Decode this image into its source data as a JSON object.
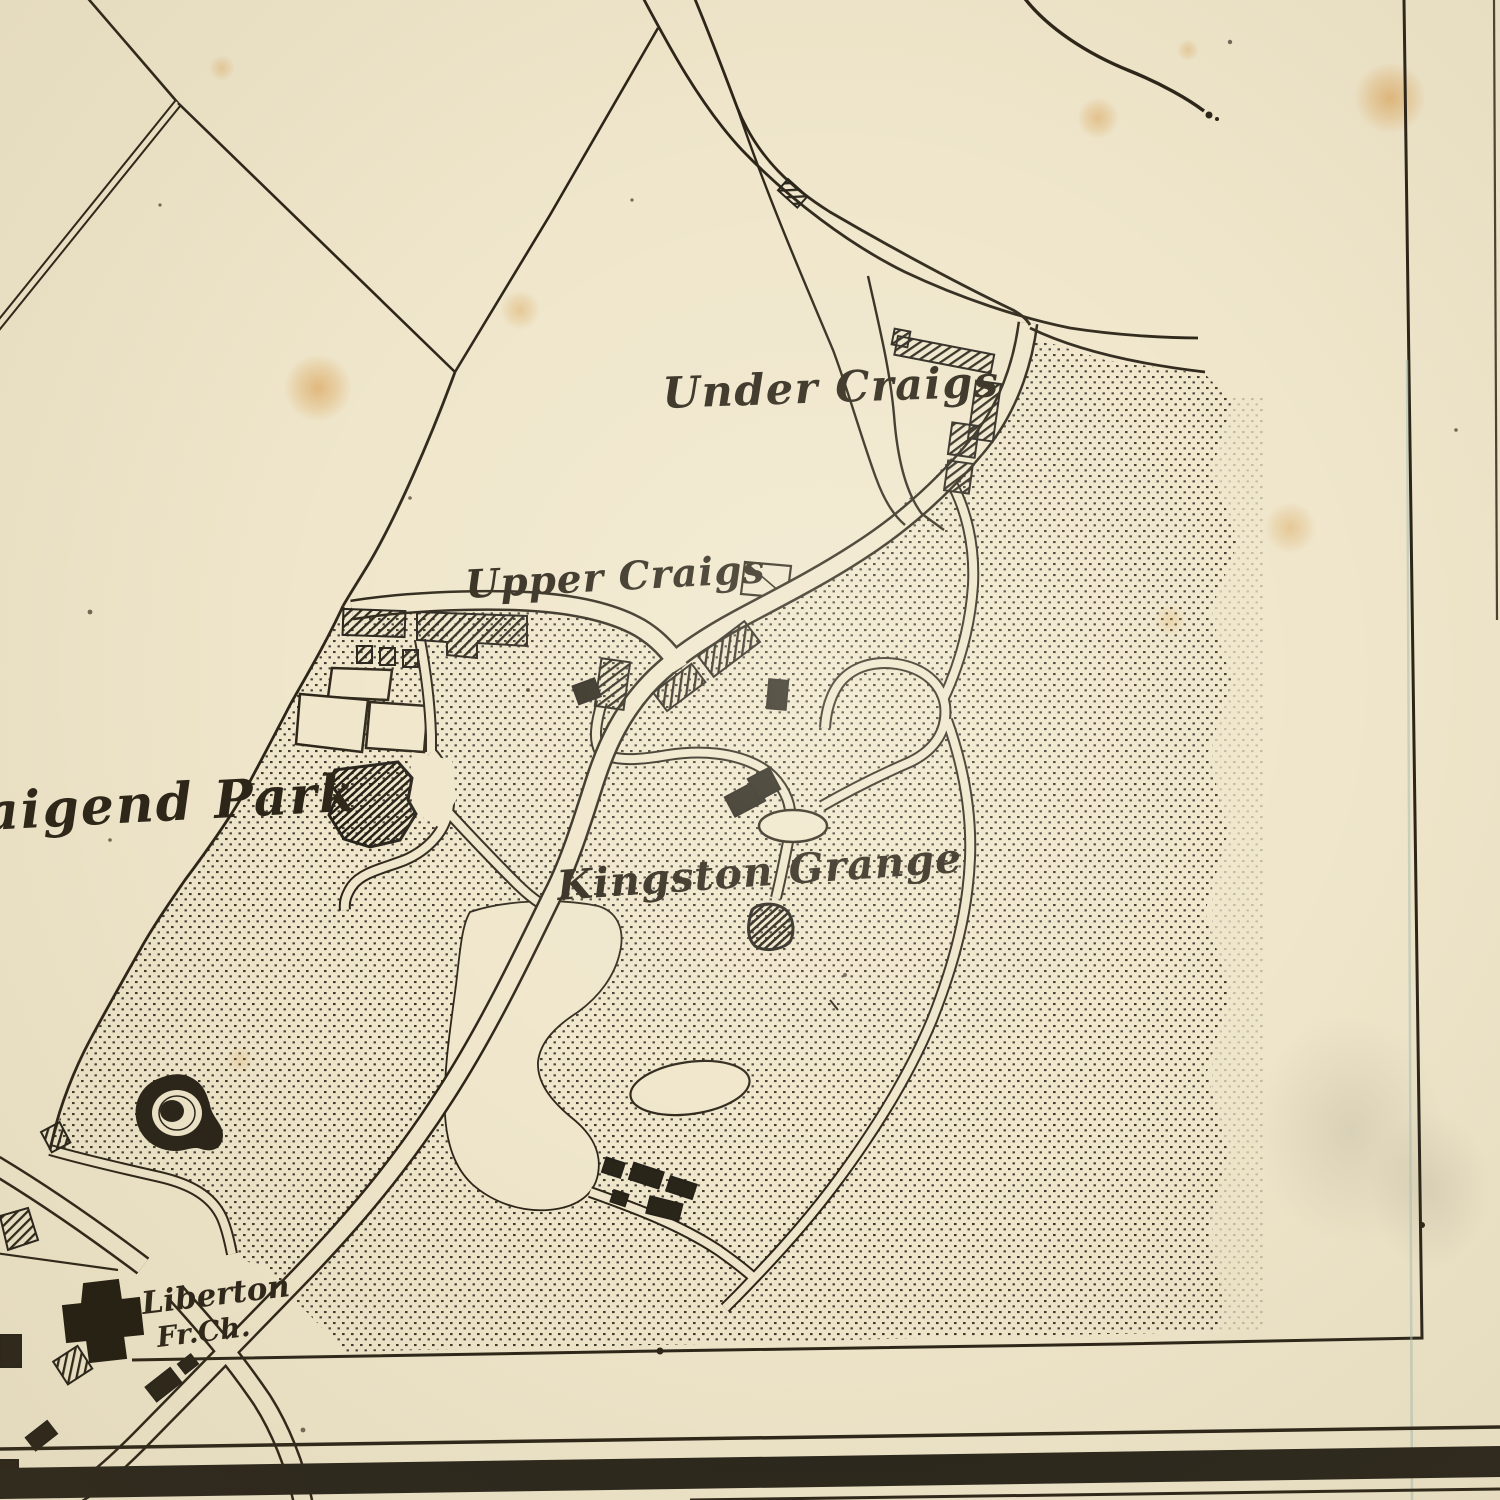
{
  "map": {
    "type": "vintage-engraved-town-plan",
    "labels": {
      "under_craigs": "Under Craigs",
      "upper_craigs": "Upper Craigs",
      "kingston_grange": "Kingston Grange",
      "craigend_park": "aigend Park",
      "liberton_line1": "Liberton",
      "liberton_line2": "Fr.Ch."
    },
    "colors": {
      "paper": "#efe6cb",
      "ink": "#2c2518",
      "stipple_dot": "#3f3a2c",
      "stain": "#d6953f",
      "border_band": "#2a261c",
      "fold_line": "#a9c0b2"
    }
  }
}
